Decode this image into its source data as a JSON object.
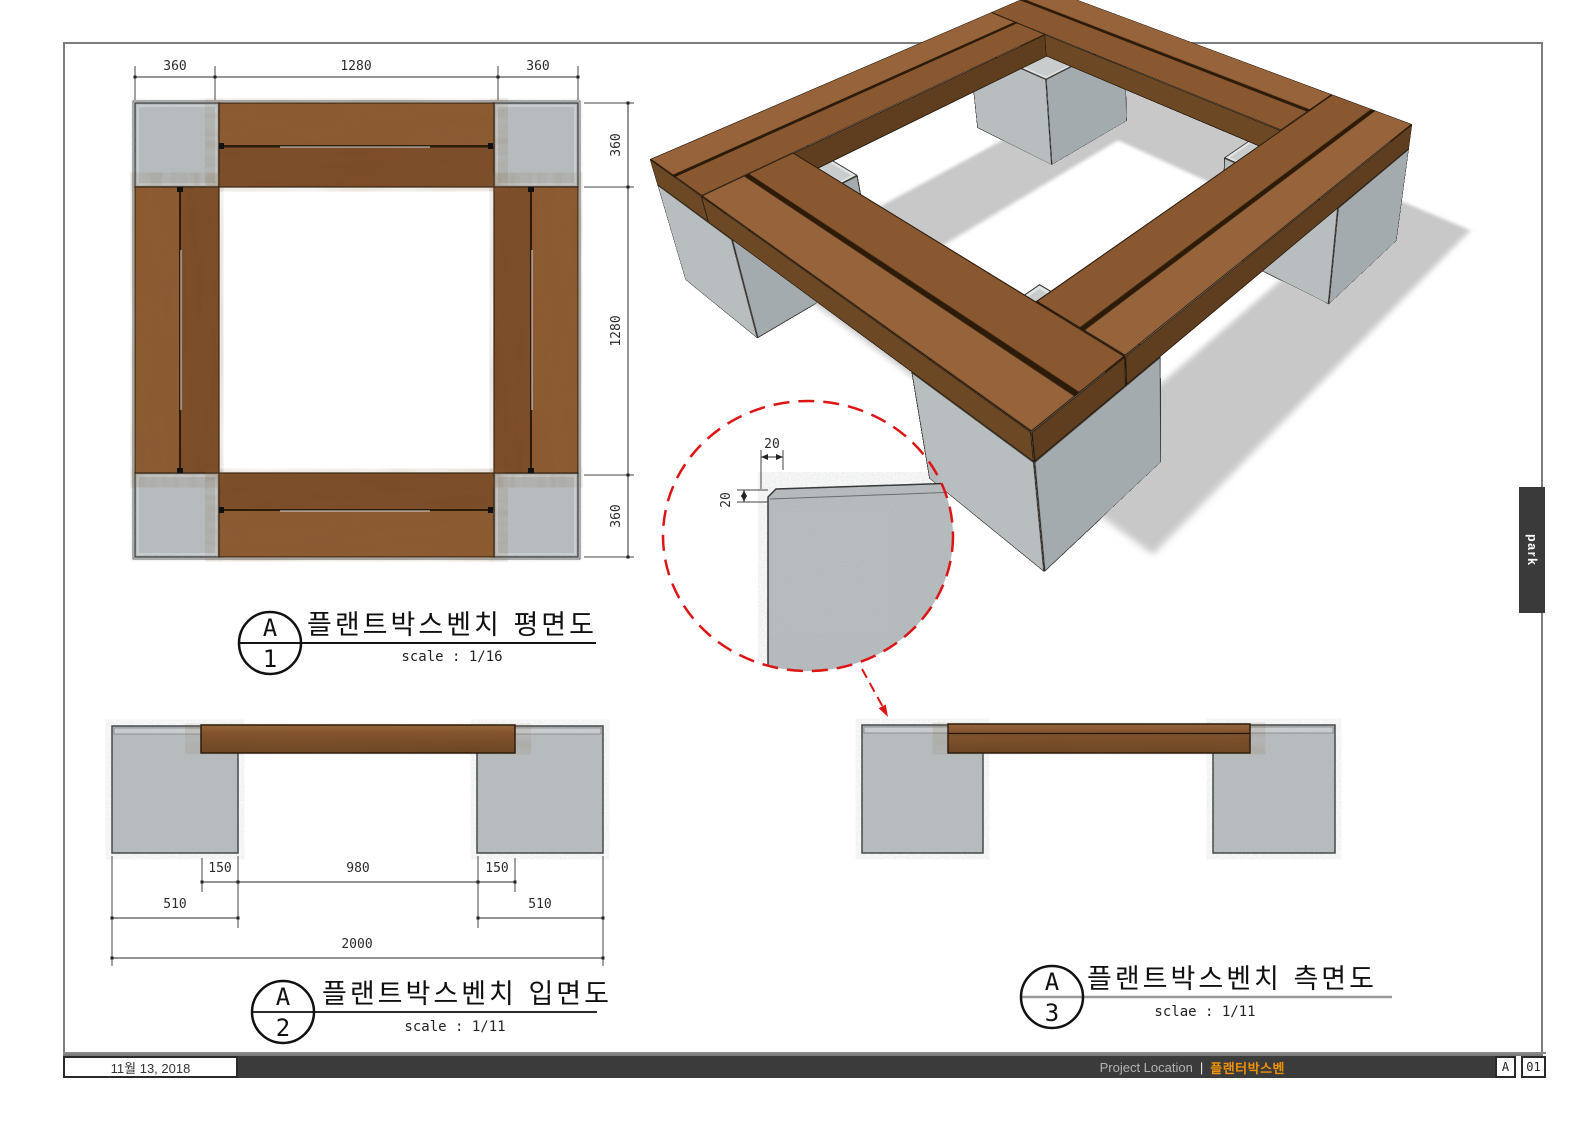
{
  "sheet": {
    "views": {
      "plan": {
        "callout_letter": "A",
        "callout_number": "1",
        "title": "플랜트박스벤치 평면도",
        "scale_label": "scale  : 1/16",
        "dims_top": [
          "360",
          "1280",
          "360"
        ],
        "dims_right": [
          "360",
          "1280",
          "360"
        ]
      },
      "elevation": {
        "callout_letter": "A",
        "callout_number": "2",
        "title": "플랜트박스벤치 입면도",
        "scale_label": "scale : 1/11",
        "dims_row1": [
          "150",
          "980",
          "150"
        ],
        "dims_row2": [
          "510",
          "510"
        ],
        "dim_total": "2000"
      },
      "side": {
        "callout_letter": "A",
        "callout_number": "3",
        "title": "플랜트박스벤치 측면도",
        "scale_label": "sclae : 1/11"
      },
      "detail": {
        "dim_h": "20",
        "dim_v": "20"
      }
    },
    "colors": {
      "wood": "#83512b",
      "wood_dark": "#6b4221",
      "concrete": "#b9bec0",
      "accent_red": "#dd1515",
      "accent_orange": "#f09200",
      "bar_dark": "#3b3b3b"
    }
  },
  "titlebar": {
    "date": "11월 13, 2018",
    "project_label": "Project Location",
    "separator": "|",
    "project_name": "플랜터박스벤",
    "sheet_letter": "A",
    "sheet_number": "01"
  },
  "side_tab": {
    "label": "park"
  }
}
